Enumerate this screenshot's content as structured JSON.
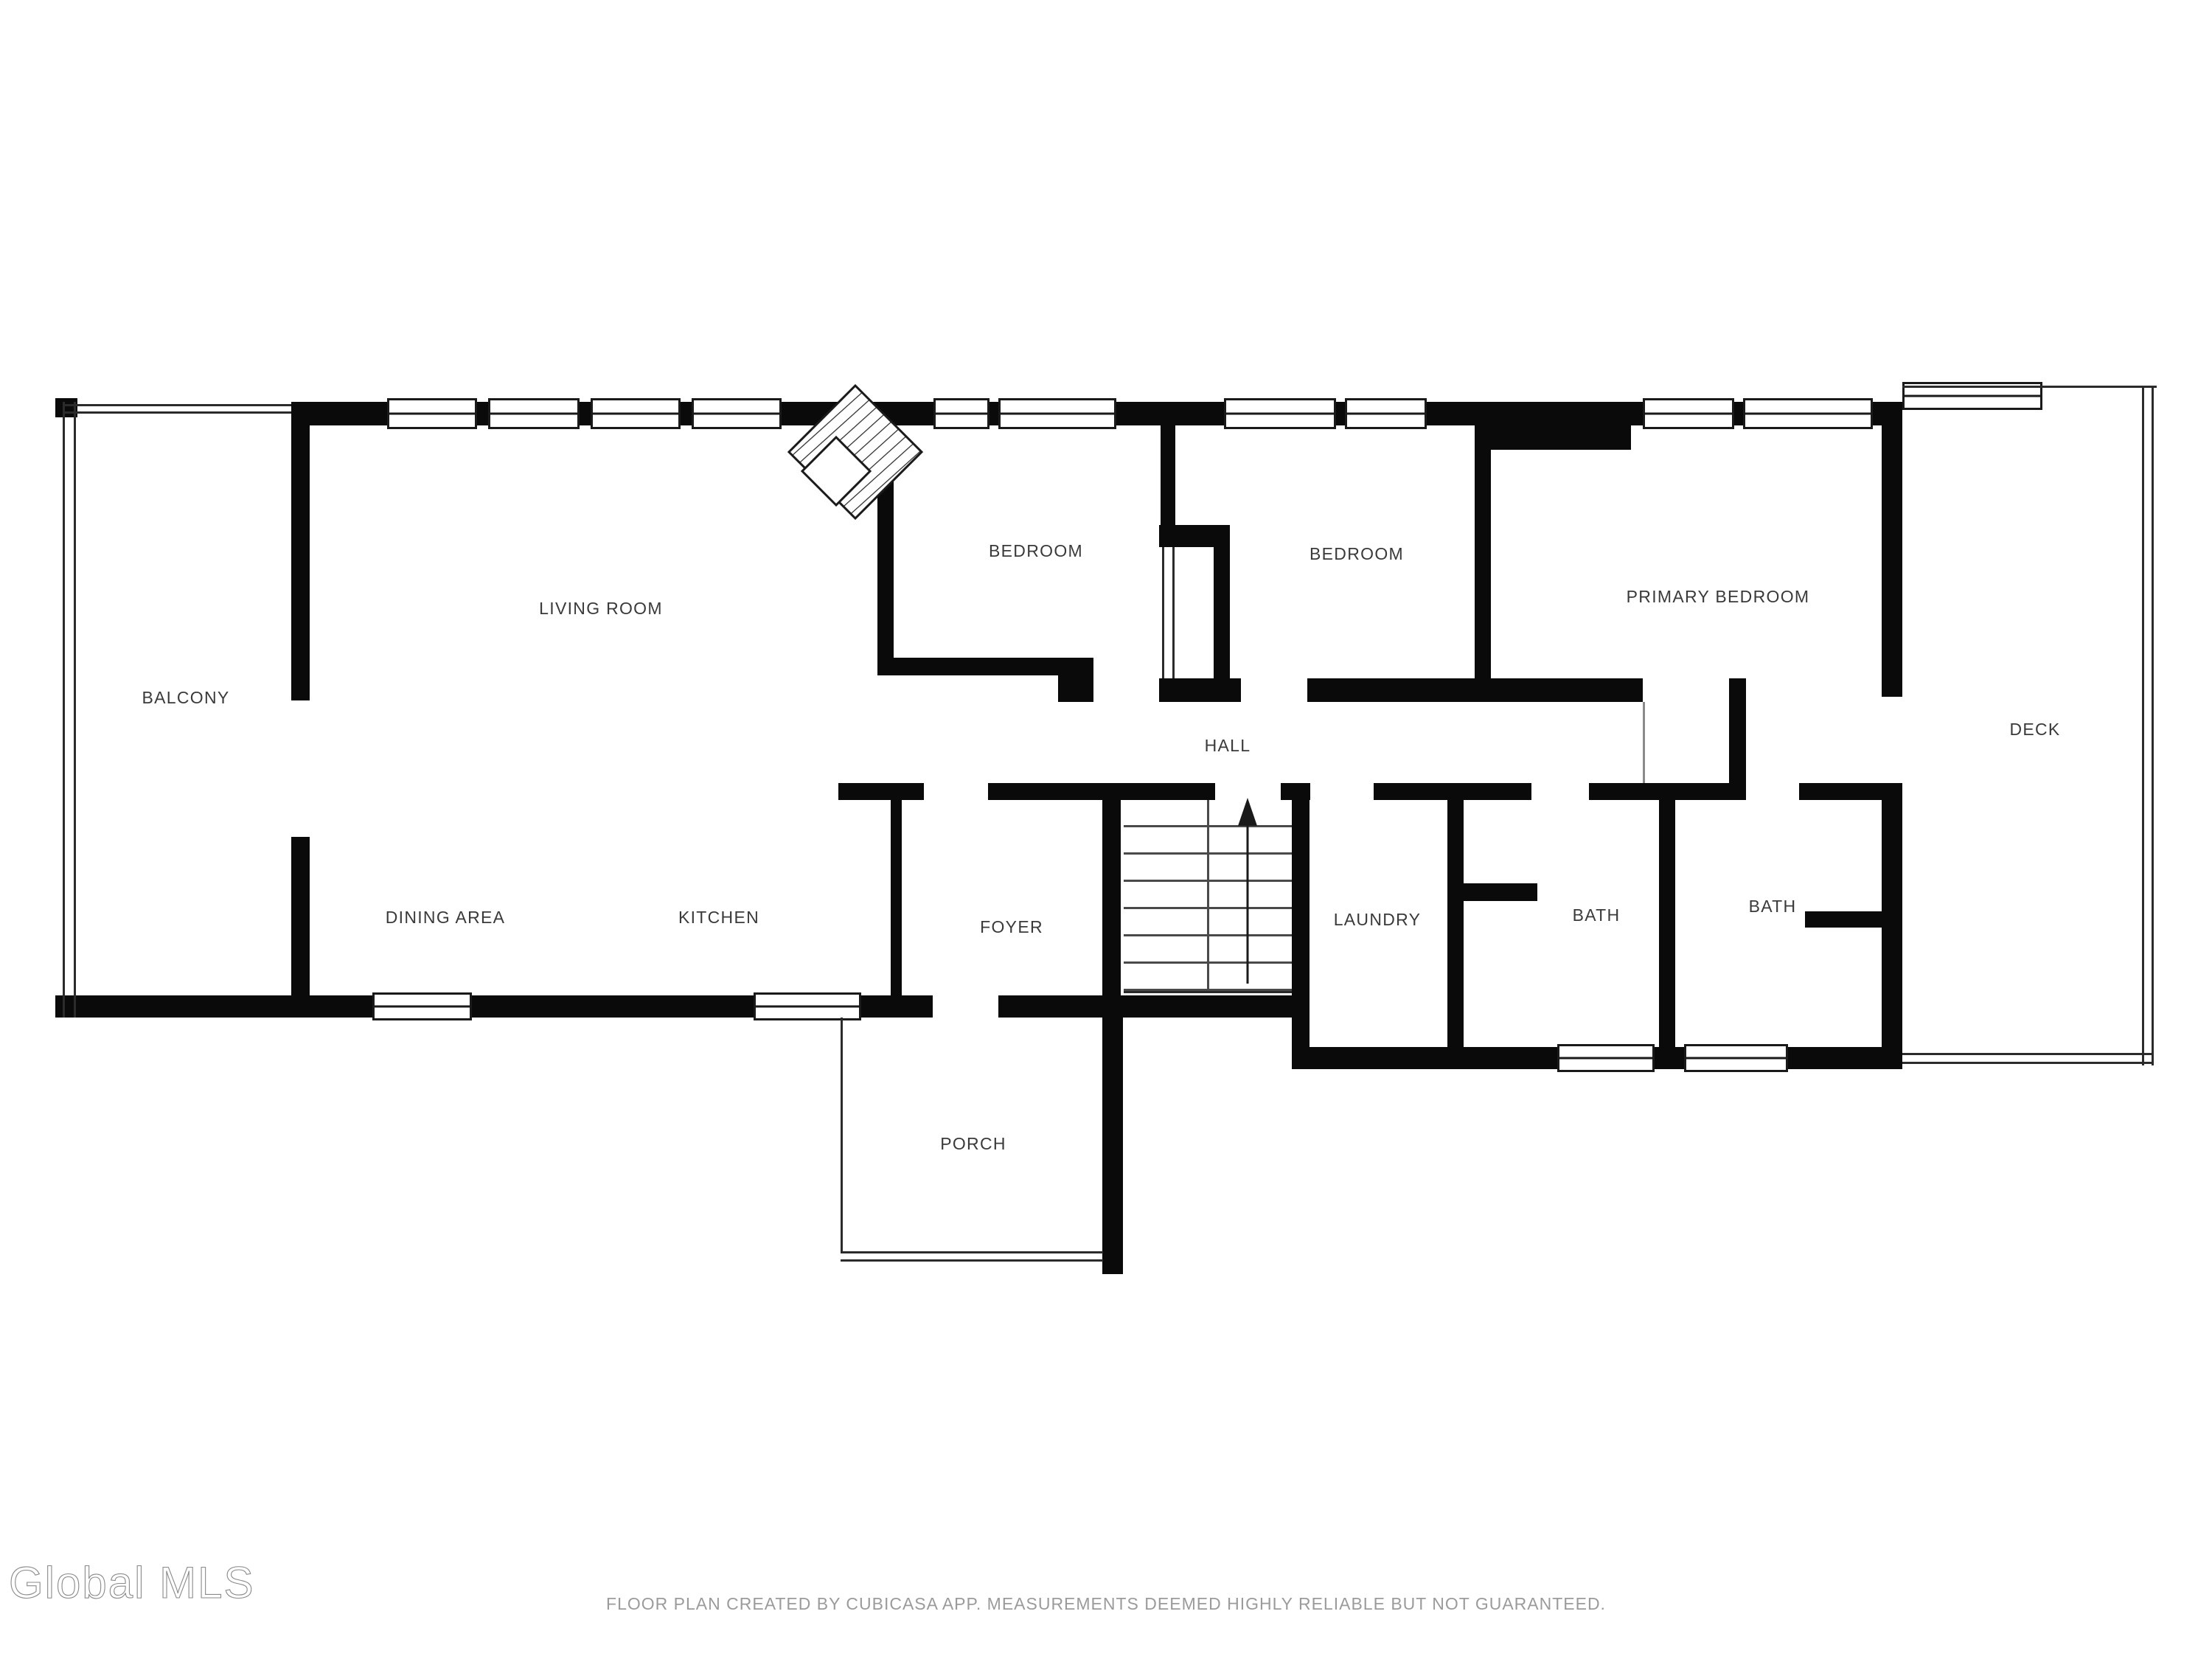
{
  "watermark": {
    "text": "Global MLS"
  },
  "footer": {
    "disclaimer": "FLOOR PLAN CREATED BY CUBICASA APP. MEASUREMENTS DEEMED HIGHLY RELIABLE BUT NOT GUARANTEED."
  },
  "floor_plan": {
    "rooms": [
      {
        "id": "balcony",
        "label": "BALCONY"
      },
      {
        "id": "living-room",
        "label": "LIVING ROOM"
      },
      {
        "id": "bedroom-1",
        "label": "BEDROOM"
      },
      {
        "id": "bedroom-2",
        "label": "BEDROOM"
      },
      {
        "id": "primary-bedroom",
        "label": "PRIMARY BEDROOM"
      },
      {
        "id": "deck",
        "label": "DECK"
      },
      {
        "id": "hall",
        "label": "HALL"
      },
      {
        "id": "dining-area",
        "label": "DINING AREA"
      },
      {
        "id": "kitchen",
        "label": "KITCHEN"
      },
      {
        "id": "foyer",
        "label": "FOYER"
      },
      {
        "id": "laundry",
        "label": "LAUNDRY"
      },
      {
        "id": "bath-1",
        "label": "BATH"
      },
      {
        "id": "bath-2",
        "label": "BATH"
      },
      {
        "id": "porch",
        "label": "PORCH"
      }
    ],
    "icons": [
      {
        "name": "fireplace-icon"
      },
      {
        "name": "stairs-up-arrow-icon"
      }
    ],
    "colors": {
      "wall": "#0a0a0a",
      "thin_line": "#2b2b2b",
      "label_text": "#3a3a3a",
      "footer_text": "#9b9b9b",
      "watermark_text": "#9a9a9a",
      "background": "#ffffff"
    }
  }
}
